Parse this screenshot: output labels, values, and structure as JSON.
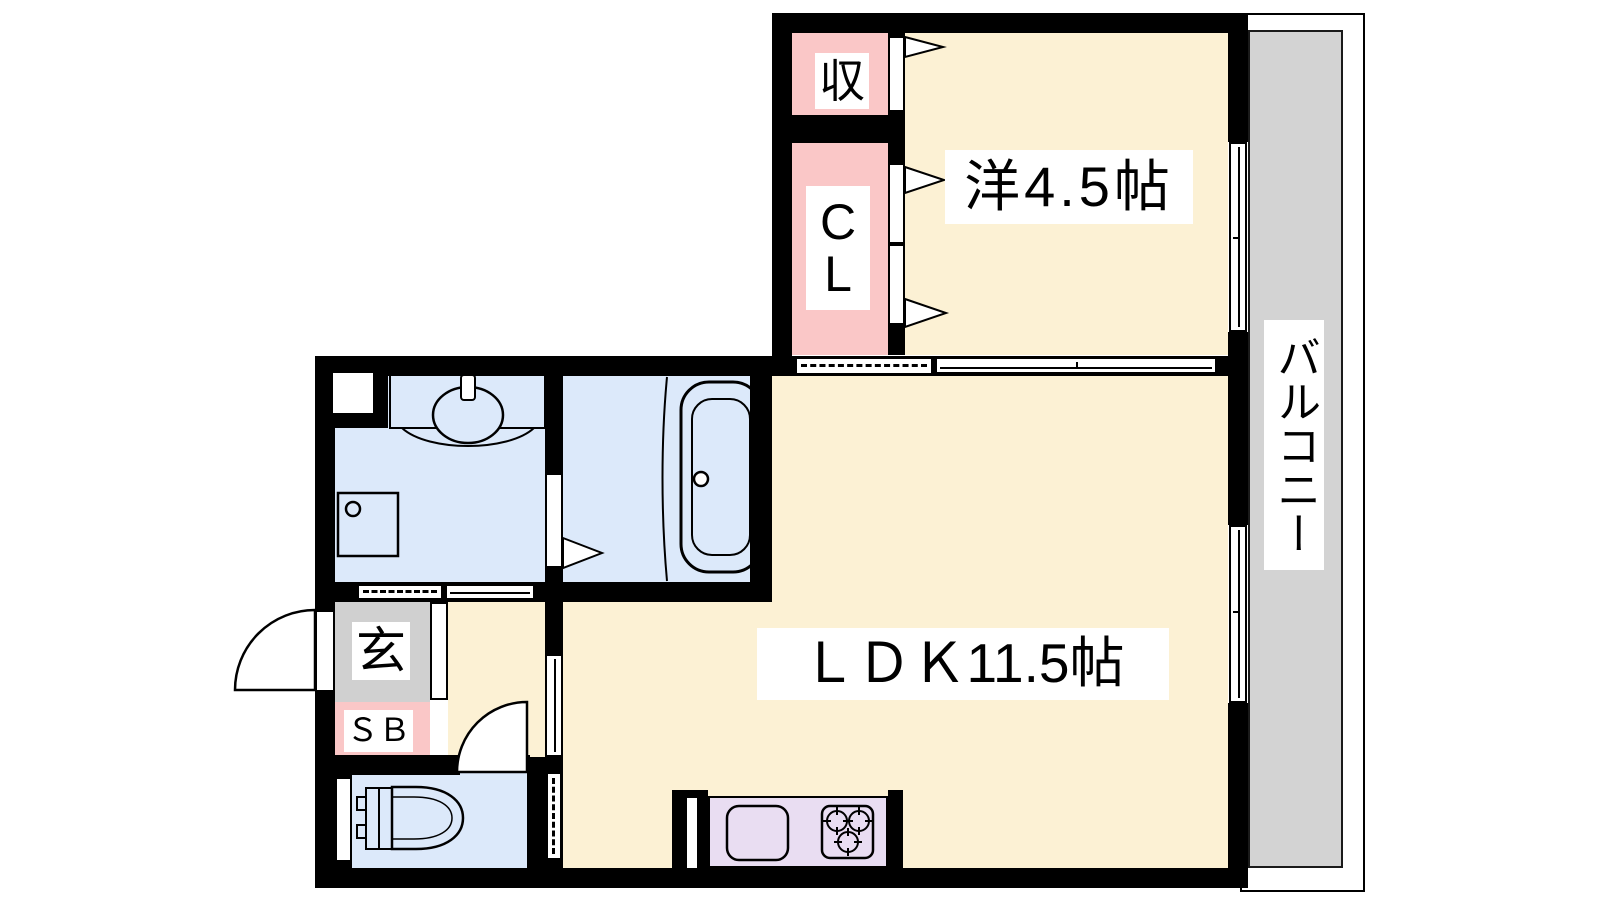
{
  "colors": {
    "wall": "#000000",
    "room_cream": "#FCF1D4",
    "closet_pink": "#FAC7C7",
    "wet_blue": "#DCE9FA",
    "entrance_gray": "#D0D0D0",
    "balcony_gray": "#D3D3D3",
    "kitchen_purple": "#E9DDF2",
    "label_bg": "#FFFFFF",
    "line": "#000000"
  },
  "rooms": {
    "storage": {
      "label": "収"
    },
    "closet": {
      "line1": "C",
      "line2": "L"
    },
    "western": {
      "label": "洋4.5帖"
    },
    "ldk": {
      "label": "ＬＤＫ11.5帖"
    },
    "balcony": {
      "label": "バルコニー"
    },
    "entrance": {
      "label": "玄"
    },
    "shoebox": {
      "label": "ＳＢ"
    }
  }
}
